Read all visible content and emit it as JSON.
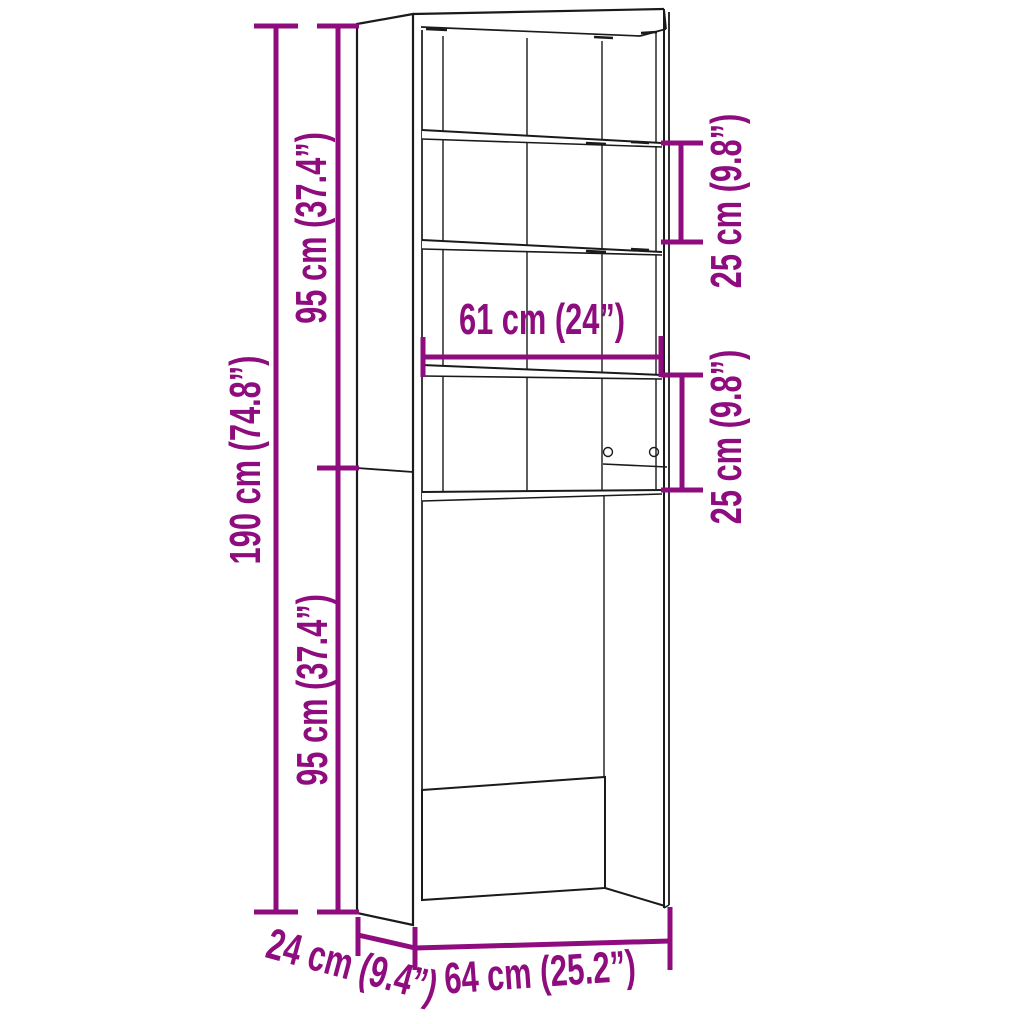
{
  "diagram": {
    "dimensions": {
      "total_height": "190 cm (74.8”)",
      "upper_section_height": "95 cm (37.4”)",
      "lower_section_height": "95 cm (37.4”)",
      "top_shelf_spacing": "25 cm (9.8”)",
      "middle_shelf_spacing": "25 cm (9.8”)",
      "inner_width": "61 cm (24”)",
      "depth": "24 cm (9.4”)",
      "outer_width": "64 cm (25.2”)"
    },
    "colors": {
      "dimension_accent": "#8E0C7E",
      "line": "#1A1A1A",
      "background": "#FFFFFF"
    }
  }
}
